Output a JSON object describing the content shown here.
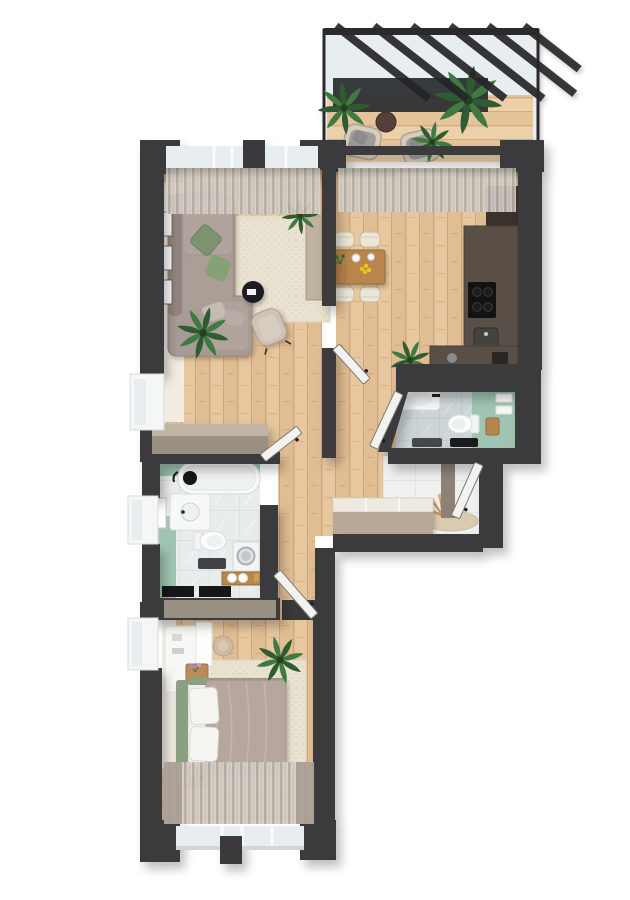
{
  "meta": {
    "kind": "3d-top-down-apartment-floor-plan-render",
    "visible_text": [],
    "canvas": {
      "width": 630,
      "height": 900
    }
  },
  "palette": {
    "wall": "#3a3a3c",
    "wall_light": "#998f83",
    "wood_base": "#e7c79f",
    "wood_line": "#cfa678",
    "teal_accent": "#9fc5b2",
    "sofa_taupe": "#a89b95",
    "pillow_green": "#7d9270",
    "bed_duvet": "#b5a69e",
    "headboard_green": "#8ba083",
    "kitchen_brown": "#5a4f46",
    "kitchen_black": "#141414",
    "table_wood": "#b9854e",
    "chair_cream": "#ece6d8",
    "rug_cream": "#eae2d0",
    "tile_white": "#eff1f1",
    "tile_gray": "#cdd4d6",
    "glass": "#e8eef0",
    "curtain": "#d7d1ca",
    "plant_green": "#3f7a41",
    "balcony_frame": "#2c2c2e",
    "door_white": "#f3f2ef",
    "wardrobe_beige": "#b7a897",
    "console_beige": "#c0b2a1"
  },
  "scene": {
    "rooms": [
      {
        "name": "balcony",
        "features": [
          "glazed pergola roof with dark beams",
          "privacy screen",
          "two rattan armchairs with grey cushions",
          "round dark side table",
          "three palm plants",
          "wood deck"
        ]
      },
      {
        "name": "living-room",
        "features": [
          "corner sofa with green pillows",
          "three wall frames",
          "woven area rug",
          "round black coffee table",
          "upholstered armchair",
          "tall beige console",
          "two potted plants",
          "sheer curtains",
          "two windows"
        ]
      },
      {
        "name": "dining-kitchen",
        "features": [
          "wood dining table",
          "four cream chairs",
          "table decor with yellow flowers",
          "L-shaped dark kitchen counter",
          "cooktop",
          "sink",
          "tall dark cabinet",
          "window bench",
          "potted palm",
          "sheer curtains"
        ]
      },
      {
        "name": "wc",
        "features": [
          "countertop washbasin",
          "wall-hung toilet",
          "teal accent wall",
          "towel shelf",
          "wooden stool",
          "black radiator",
          "dark storage cabinet"
        ]
      },
      {
        "name": "bathroom",
        "features": [
          "bathtub with black shower set",
          "vanity washbasin with mirror",
          "wall-hung toilet",
          "washing machine",
          "wooden towel bench",
          "teal walls",
          "left-wall window",
          "two black radiators"
        ]
      },
      {
        "name": "hallway",
        "features": [
          "open white interior doors to dining, wc, bathroom and bedroom",
          "oak floor"
        ]
      },
      {
        "name": "entry",
        "features": [
          "sliding-door wardrobe",
          "open entrance door",
          "round jute rug",
          "pampas grass",
          "white floor tiles"
        ]
      },
      {
        "name": "bedroom",
        "features": [
          "double bed with taupe duvet and green headboard",
          "two white pillows",
          "vanity desk with shelf",
          "round pouf",
          "two wooden nightstands",
          "flower vase",
          "potted palm",
          "area rug",
          "full-width curtains over bottom windows",
          "left-wall window"
        ]
      }
    ]
  }
}
